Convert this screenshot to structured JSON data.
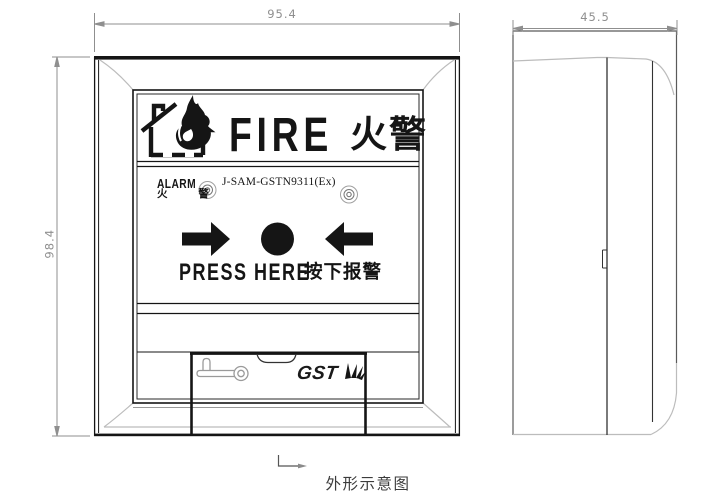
{
  "figure": {
    "caption": "外形示意图"
  },
  "front_view": {
    "width_mm": "95.4",
    "height_mm": "98.4",
    "header": {
      "label_en": "FIRE",
      "label_zh": "火警"
    },
    "status_row": {
      "alarm_en": "ALARM",
      "alarm_zh": "火 警",
      "model": "J-SAM-GSTN9311(Ex)"
    },
    "press_row": {
      "label_en": "PRESS HERE",
      "label_zh": "按下报警"
    },
    "brand": "GST"
  },
  "side_view": {
    "depth_mm": "45.5"
  },
  "icons": {
    "header_icon": "burning-house-icon",
    "press_left": "arrow-right-icon",
    "press_right": "arrow-left-icon",
    "press_button": "round-press-button",
    "unlock": "key-icon",
    "indicator_left": "led-indicator-icon",
    "indicator_right": "led-indicator-icon",
    "brand_mark": "starburst-fan-icon",
    "section_mark": "l-leader-arrow-icon"
  },
  "colors": {
    "line_dark": "#151515",
    "side_outline_gray": "#5a5a5a",
    "bevel_gray": "#bcbcbc",
    "dim_gray": "#8f8f8f",
    "background": "#ffffff"
  }
}
